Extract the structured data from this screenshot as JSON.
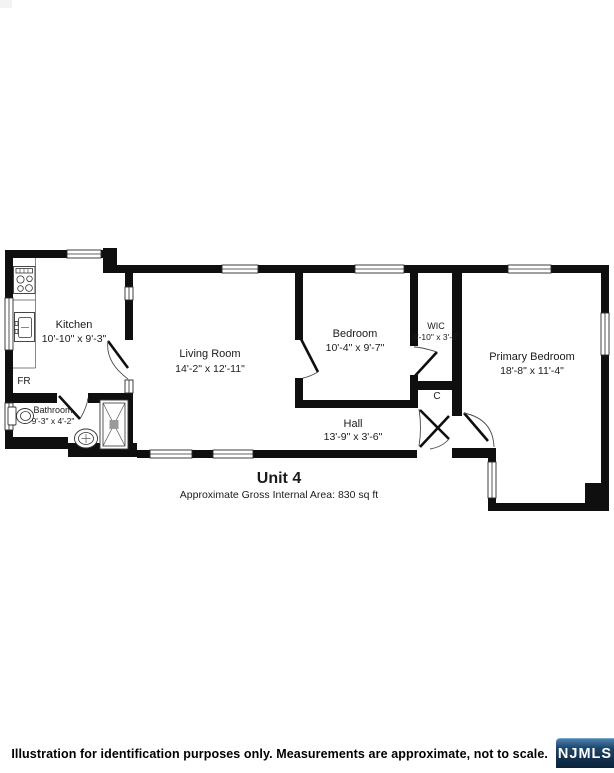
{
  "plan": {
    "unit_title": "Unit 4",
    "area_note": "Approximate Gross Internal Area: 830 sq ft",
    "rooms": [
      {
        "name": "Kitchen",
        "dims": "10'-10\" x 9'-3\""
      },
      {
        "name": "Living Room",
        "dims": "14'-2\" x 12'-11\""
      },
      {
        "name": "Bedroom",
        "dims": "10'-4\" x 9'-7\""
      },
      {
        "name": "WIC",
        "dims": "8'-10\" x 3'-6\""
      },
      {
        "name": "Primary Bedroom",
        "dims": "18'-8\" x 11'-4\""
      },
      {
        "name": "Hall",
        "dims": "13'-9\" x 3'-6\""
      },
      {
        "name": "Bathroom",
        "dims": "9'-3\" x 4'-2\""
      }
    ],
    "labels": {
      "fridge": "FR",
      "closet": "C"
    }
  },
  "footer": {
    "disclaimer": "Illustration for identification purposes only. Measurements are approximate, not to scale.",
    "brand": "NJMLS"
  },
  "colors": {
    "wall": "#0f0f0f",
    "text": "#1b1b1b",
    "badge_top": "#4a7fae",
    "badge_bottom": "#0b2238",
    "badge_text": "#ffffff"
  }
}
